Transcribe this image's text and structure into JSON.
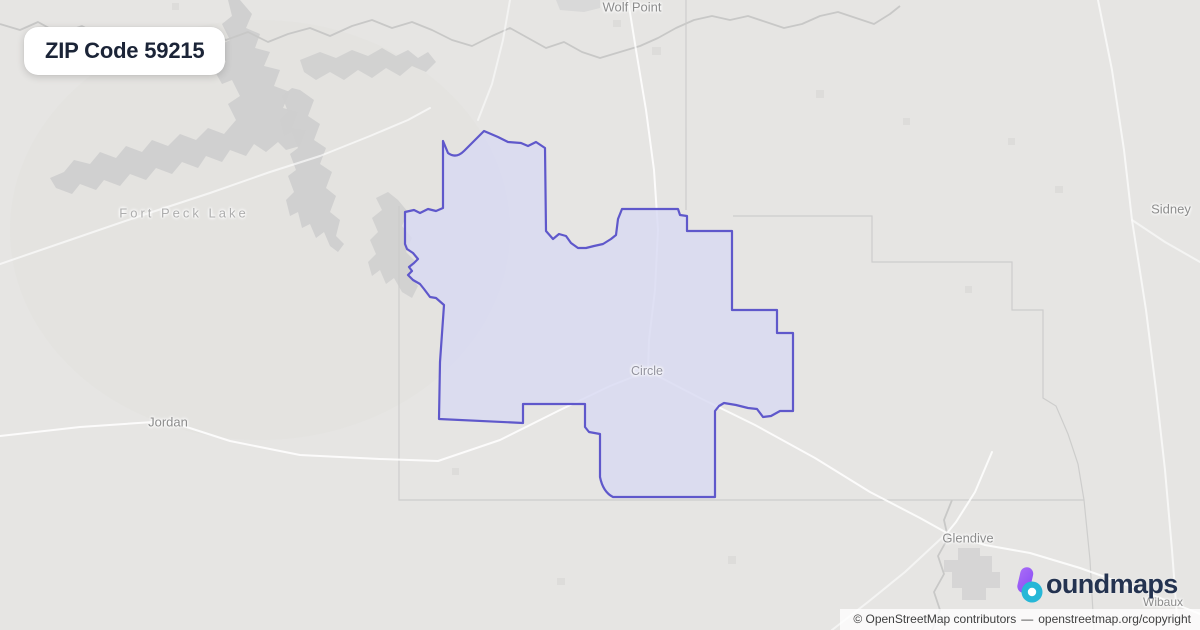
{
  "badge": {
    "title": "ZIP Code 59215"
  },
  "map": {
    "labels": [
      {
        "name": "wolf-point",
        "text": "Wolf Point",
        "type": "town"
      },
      {
        "name": "fort-peck-lake",
        "text": "Fort Peck Lake",
        "type": "water"
      },
      {
        "name": "sidney",
        "text": "Sidney",
        "type": "town"
      },
      {
        "name": "jordan",
        "text": "Jordan",
        "type": "town"
      },
      {
        "name": "circle",
        "text": "Circle",
        "type": "town"
      },
      {
        "name": "glendive",
        "text": "Glendive",
        "type": "town"
      },
      {
        "name": "wibaux",
        "text": "Wibaux",
        "type": "town"
      }
    ]
  },
  "logo": {
    "name": "boundmaps",
    "wordmark_rest": "oundmaps"
  },
  "attribution": {
    "prefix": "© OpenStreetMap contributors",
    "separator": "—",
    "link": "openstreetmap.org/copyright"
  },
  "colors": {
    "map_bg": "#e6e5e3",
    "water_gray": "#cfcfcf",
    "zip_fill": "#d8d9f1",
    "zip_border": "#5f58cb",
    "badge_text": "#1b2437",
    "logo_navy": "#243350",
    "logo_purple": "#8a4df5",
    "logo_purple_light": "#a86bf7",
    "logo_teal": "#26b7d7",
    "road_white": "#ffffff",
    "admin_line": "#cbcbca",
    "river_gray": "#c8c8c7",
    "label_gray": "#8c8c8c"
  }
}
